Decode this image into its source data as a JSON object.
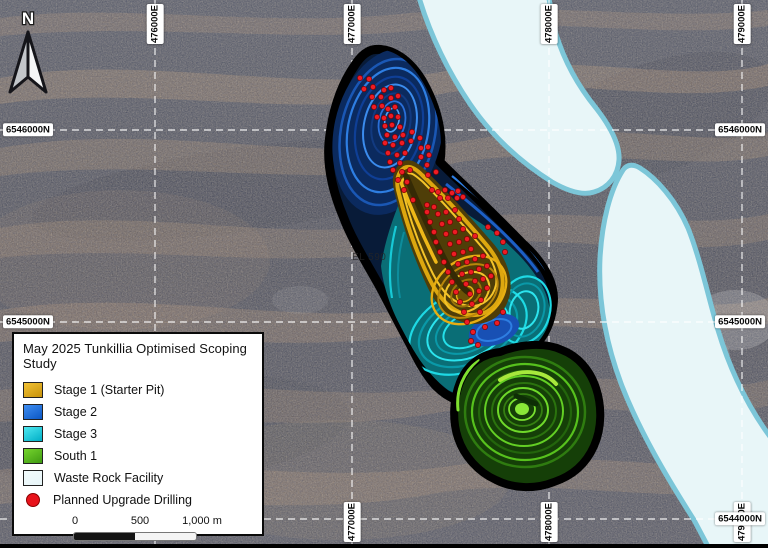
{
  "map": {
    "north_label": "N",
    "annotations": [
      {
        "text": "EL 590",
        "x": 352,
        "y": 252
      }
    ],
    "grid": {
      "eastings": [
        {
          "label": "476000E",
          "x": 155,
          "top": true,
          "bottom": false
        },
        {
          "label": "477000E",
          "x": 352,
          "top": true,
          "bottom": true
        },
        {
          "label": "478000E",
          "x": 549,
          "top": true,
          "bottom": true
        },
        {
          "label": "479000E",
          "x": 742,
          "top": true,
          "bottom": true
        }
      ],
      "northings": [
        {
          "label": "6546000N",
          "y": 130,
          "left": true,
          "right": true
        },
        {
          "label": "6545000N",
          "y": 322,
          "left": true,
          "right": true
        },
        {
          "label": "6544000N",
          "y": 519,
          "left": false,
          "right": true
        }
      ]
    },
    "drill_dots": [
      [
        360,
        78
      ],
      [
        369,
        79
      ],
      [
        364,
        89
      ],
      [
        373,
        87
      ],
      [
        384,
        90
      ],
      [
        391,
        88
      ],
      [
        372,
        97
      ],
      [
        381,
        97
      ],
      [
        391,
        98
      ],
      [
        398,
        96
      ],
      [
        374,
        107
      ],
      [
        382,
        106
      ],
      [
        388,
        109
      ],
      [
        395,
        107
      ],
      [
        377,
        117
      ],
      [
        384,
        118
      ],
      [
        391,
        116
      ],
      [
        398,
        117
      ],
      [
        385,
        126
      ],
      [
        392,
        125
      ],
      [
        400,
        127
      ],
      [
        387,
        135
      ],
      [
        395,
        137
      ],
      [
        403,
        135
      ],
      [
        412,
        132
      ],
      [
        385,
        143
      ],
      [
        393,
        145
      ],
      [
        402,
        143
      ],
      [
        411,
        141
      ],
      [
        420,
        138
      ],
      [
        388,
        153
      ],
      [
        397,
        155
      ],
      [
        405,
        153
      ],
      [
        421,
        148
      ],
      [
        428,
        147
      ],
      [
        390,
        162
      ],
      [
        400,
        163
      ],
      [
        421,
        157
      ],
      [
        429,
        155
      ],
      [
        393,
        170
      ],
      [
        402,
        172
      ],
      [
        410,
        170
      ],
      [
        427,
        165
      ],
      [
        398,
        180
      ],
      [
        407,
        182
      ],
      [
        428,
        175
      ],
      [
        436,
        172
      ],
      [
        404,
        190
      ],
      [
        432,
        190
      ],
      [
        438,
        192
      ],
      [
        445,
        190
      ],
      [
        452,
        193
      ],
      [
        458,
        191
      ],
      [
        440,
        198
      ],
      [
        448,
        198
      ],
      [
        457,
        198
      ],
      [
        463,
        197
      ],
      [
        413,
        200
      ],
      [
        427,
        205
      ],
      [
        434,
        207
      ],
      [
        427,
        212
      ],
      [
        438,
        214
      ],
      [
        446,
        212
      ],
      [
        455,
        210
      ],
      [
        430,
        222
      ],
      [
        442,
        224
      ],
      [
        450,
        222
      ],
      [
        459,
        219
      ],
      [
        434,
        232
      ],
      [
        446,
        234
      ],
      [
        455,
        232
      ],
      [
        463,
        229
      ],
      [
        488,
        227
      ],
      [
        436,
        242
      ],
      [
        450,
        244
      ],
      [
        459,
        242
      ],
      [
        467,
        239
      ],
      [
        475,
        236
      ],
      [
        497,
        233
      ],
      [
        440,
        252
      ],
      [
        454,
        254
      ],
      [
        463,
        252
      ],
      [
        471,
        249
      ],
      [
        503,
        242
      ],
      [
        444,
        262
      ],
      [
        458,
        264
      ],
      [
        467,
        262
      ],
      [
        475,
        259
      ],
      [
        483,
        256
      ],
      [
        505,
        252
      ],
      [
        448,
        272
      ],
      [
        462,
        274
      ],
      [
        471,
        272
      ],
      [
        479,
        269
      ],
      [
        487,
        266
      ],
      [
        452,
        282
      ],
      [
        466,
        284
      ],
      [
        475,
        281
      ],
      [
        483,
        279
      ],
      [
        491,
        276
      ],
      [
        456,
        292
      ],
      [
        470,
        294
      ],
      [
        479,
        291
      ],
      [
        487,
        288
      ],
      [
        460,
        302
      ],
      [
        472,
        304
      ],
      [
        481,
        300
      ],
      [
        464,
        312
      ],
      [
        480,
        312
      ],
      [
        503,
        312
      ],
      [
        467,
        322
      ],
      [
        497,
        323
      ],
      [
        473,
        332
      ],
      [
        485,
        327
      ],
      [
        471,
        341
      ],
      [
        478,
        345
      ]
    ]
  },
  "legend": {
    "title": "May 2025 Tunkillia Optimised Scoping Study",
    "items": [
      {
        "label": "Stage 1 (Starter Pit)",
        "shape": "square",
        "color1": "#c7920b",
        "color2": "#f2c235"
      },
      {
        "label": "Stage 2",
        "shape": "square",
        "color1": "#0b57c4",
        "color2": "#3f8ef2"
      },
      {
        "label": "Stage 3",
        "shape": "square",
        "color1": "#00aec6",
        "color2": "#4fe8f0"
      },
      {
        "label": "South 1",
        "shape": "square",
        "color1": "#3f9a12",
        "color2": "#76d52e"
      },
      {
        "label": "Waste Rock Facility",
        "shape": "square",
        "color1": "#e7f5f8",
        "color2": "#f2fbfc"
      },
      {
        "label": "Planned Upgrade Drilling",
        "shape": "circle",
        "color1": "#e8131b",
        "color2": "#e8131b"
      }
    ],
    "scale_bar": {
      "tick0": "0",
      "tick1": "500",
      "tick2": "1,000 m"
    }
  }
}
